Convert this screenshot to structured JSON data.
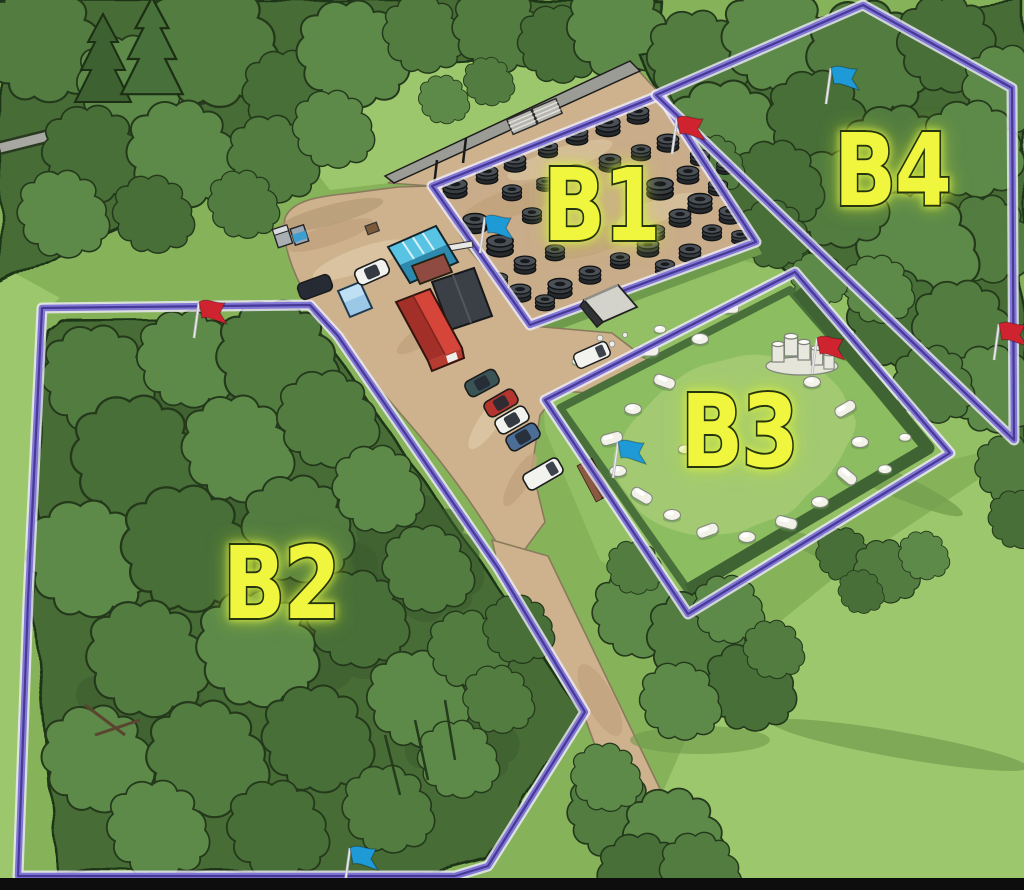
{
  "map": {
    "zones": [
      {
        "id": "b1",
        "label": "B1",
        "terrain": "tire-field"
      },
      {
        "id": "b2",
        "label": "B2",
        "terrain": "forest"
      },
      {
        "id": "b3",
        "label": "B3",
        "terrain": "inflatable-bunker-field"
      },
      {
        "id": "b4",
        "label": "B4",
        "terrain": "forest"
      }
    ],
    "flags": [
      {
        "zone": "b1",
        "color": "blue",
        "x": 480,
        "y": 253
      },
      {
        "zone": "b1",
        "color": "red",
        "x": 672,
        "y": 154
      },
      {
        "zone": "b2",
        "color": "red",
        "x": 194,
        "y": 338
      },
      {
        "zone": "b2",
        "color": "blue",
        "x": 345,
        "y": 884
      },
      {
        "zone": "b3",
        "color": "blue",
        "x": 613,
        "y": 478
      },
      {
        "zone": "b3",
        "color": "red",
        "x": 812,
        "y": 374
      },
      {
        "zone": "b4",
        "color": "blue",
        "x": 826,
        "y": 104
      },
      {
        "zone": "b4",
        "color": "red",
        "x": 994,
        "y": 360
      }
    ],
    "colors": {
      "boundary": "#8175d6",
      "zone_label_fill": "#f0f63e",
      "flag_red": "#cf2430",
      "flag_blue": "#1e9ad6"
    }
  }
}
